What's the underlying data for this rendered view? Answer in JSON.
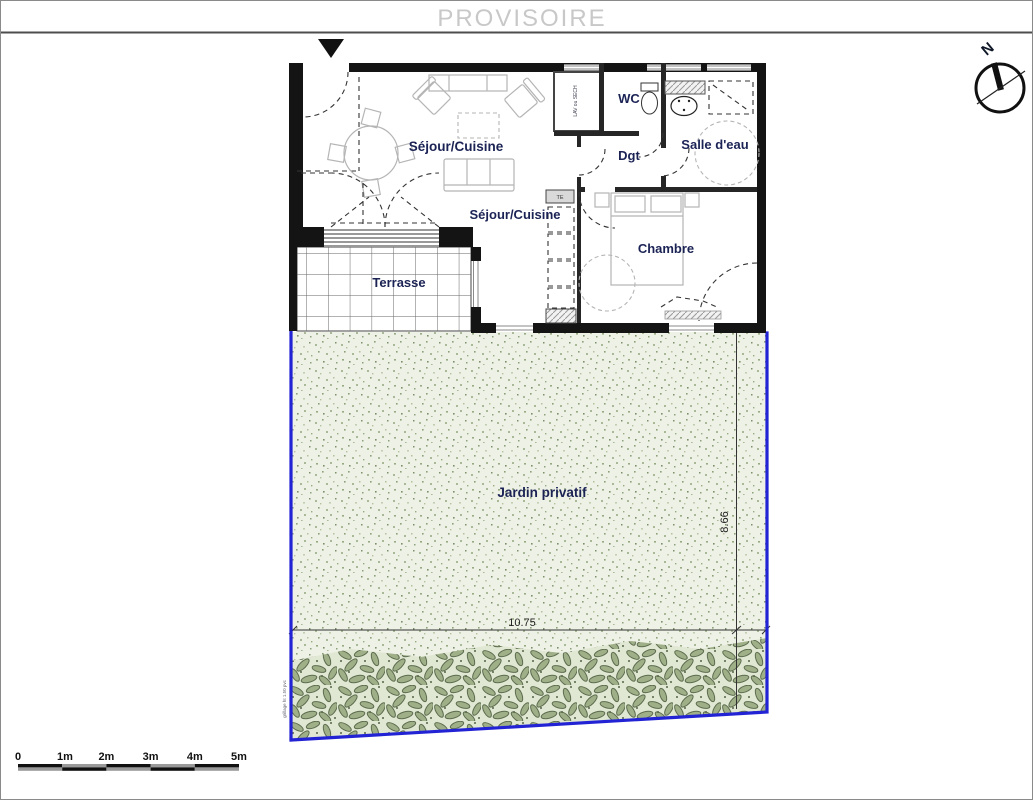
{
  "title": "PROVISOIRE",
  "compass": {
    "north": "N"
  },
  "rooms": {
    "sejour_upper": "Séjour/Cuisine",
    "sejour_lower": "Séjour/Cuisine",
    "wc": "WC",
    "dgt": "Dgt",
    "salle_eau": "Salle d'eau",
    "chambre": "Chambre",
    "terrasse": "Terrasse",
    "jardin": "Jardin privatif"
  },
  "annotations": {
    "closet": "LAV ou SECH",
    "elec": "TE",
    "fence": "grillage ht 1.50 pvc"
  },
  "dimensions": {
    "garden_width": "10.75",
    "garden_depth": "8.66"
  },
  "scale": {
    "labels": [
      "0",
      "1m",
      "2m",
      "3m",
      "4m",
      "5m"
    ]
  },
  "colors": {
    "boundary_blue": "#2323d6",
    "label_navy": "#1b2355",
    "garden_green": "#eef1e5",
    "hedge_green": "#5c6c4e",
    "wall_black": "#141414",
    "title_gray": "#c8c8c8"
  }
}
